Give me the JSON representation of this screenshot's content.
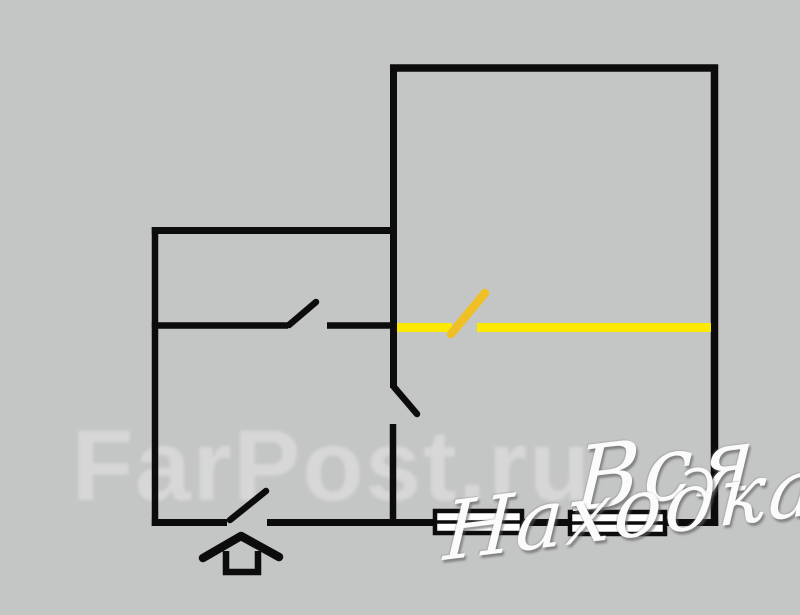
{
  "background": "#c4c5c5",
  "colors": {
    "wall": "#0c0c0c",
    "highlight_yellow": "#fce903",
    "highlight_gold": "#f0bf25",
    "farpost_watermark": "#d9d9d9",
    "script_watermark": "#fbfbfb",
    "window_fill": "#ffffff"
  },
  "watermarks": {
    "farpost_text": "FarPost.ru",
    "script_line1": "Вся",
    "script_line2": "Находка"
  },
  "plan": {
    "canvas": {
      "width": 800,
      "height": 615
    },
    "walls": [
      {
        "id": "room-top-wall",
        "x1": 390,
        "y1": 68,
        "x2": 718,
        "y2": 68,
        "w": 7.5
      },
      {
        "id": "room-right-wall",
        "x1": 714.5,
        "y1": 64.5,
        "x2": 714.5,
        "y2": 526,
        "w": 7.5
      },
      {
        "id": "room-left-wall-upper",
        "x1": 393.5,
        "y1": 64.5,
        "x2": 393.5,
        "y2": 388,
        "w": 7
      },
      {
        "id": "hall-kitchen-wall-lower",
        "x1": 393,
        "y1": 424,
        "x2": 393,
        "y2": 524,
        "w": 6.5
      },
      {
        "id": "small-room-top-wall",
        "x1": 151.8,
        "y1": 230.5,
        "x2": 397,
        "y2": 230.5,
        "w": 7
      },
      {
        "id": "small-room-left-wall",
        "x1": 155,
        "y1": 227,
        "x2": 155,
        "y2": 526,
        "w": 6.5
      },
      {
        "id": "small-room-bottom-wall-left",
        "x1": 151.8,
        "y1": 325.5,
        "x2": 288,
        "y2": 325.5,
        "w": 6.5
      },
      {
        "id": "small-room-bottom-wall-right",
        "x1": 327,
        "y1": 325.5,
        "x2": 397,
        "y2": 325.5,
        "w": 6.5
      },
      {
        "id": "bottom-wall-left",
        "x1": 151.8,
        "y1": 522.5,
        "x2": 227,
        "y2": 522.5,
        "w": 7
      },
      {
        "id": "bottom-wall-main",
        "x1": 267,
        "y1": 522.5,
        "x2": 718.2,
        "y2": 522.5,
        "w": 7
      }
    ],
    "door_leaves": [
      {
        "id": "small-room-door-leaf",
        "x1": 289,
        "y1": 325,
        "x2": 316,
        "y2": 302,
        "w": 6.5
      },
      {
        "id": "kitchen-door-leaf",
        "x1": 394,
        "y1": 387,
        "x2": 417,
        "y2": 414,
        "w": 6.5
      },
      {
        "id": "entrance-door-leaf",
        "x1": 230,
        "y1": 520,
        "x2": 266,
        "y2": 491,
        "w": 6.5
      }
    ],
    "yellow_segments": [
      {
        "id": "yellow-wall-left",
        "x1": 397,
        "y1": 327.5,
        "x2": 452,
        "y2": 327.5,
        "w": 9,
        "color": "highlight_yellow",
        "cap": "butt"
      },
      {
        "id": "yellow-wall-right",
        "x1": 477,
        "y1": 327.5,
        "x2": 711,
        "y2": 327.5,
        "w": 9,
        "color": "highlight_yellow",
        "cap": "butt"
      },
      {
        "id": "yellow-door-leaf",
        "x1": 451,
        "y1": 334,
        "x2": 485,
        "y2": 293,
        "w": 8.5,
        "color": "highlight_gold",
        "cap": "round"
      }
    ],
    "windows": [
      {
        "id": "window-1",
        "x": 435,
        "y": 511,
        "w": 87,
        "h": 22
      },
      {
        "id": "window-2",
        "x": 570,
        "y": 512,
        "w": 95,
        "h": 22
      }
    ],
    "entrance_arrow": {
      "chevron": [
        [
          203,
          558
        ],
        [
          241,
          536
        ],
        [
          279,
          557
        ]
      ],
      "stem": {
        "x": 226,
        "y": 551,
        "w": 32,
        "h": 21
      },
      "stroke": 8.5
    }
  }
}
